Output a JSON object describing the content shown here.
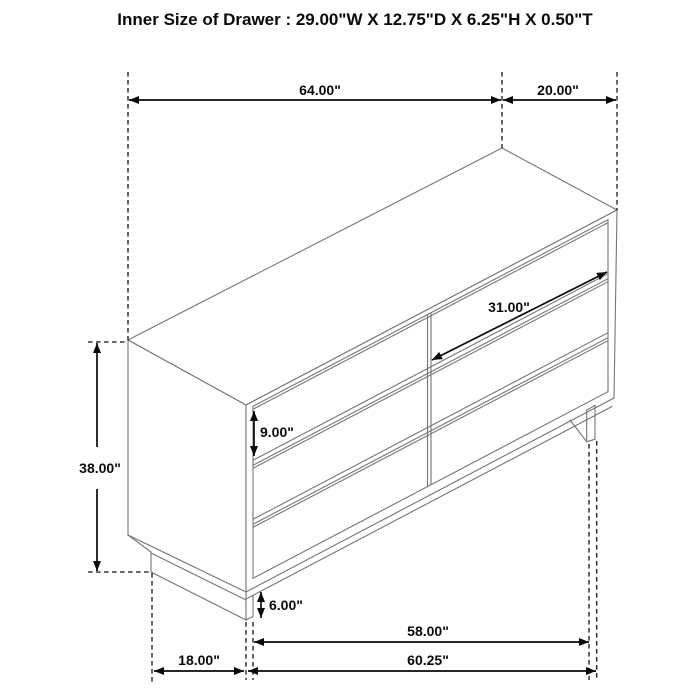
{
  "title": "Inner Size of Drawer : 29.00\"W X 12.75\"D X 6.25\"H X 0.50\"T",
  "figure": {
    "type": "furniture dimension diagram",
    "item": "dresser with 6 drawers (2 columns x 3 rows)",
    "view": "isometric line drawing"
  },
  "dimensions": {
    "top_width": "64.00\"",
    "top_depth": "20.00\"",
    "drawer_width": "31.00\"",
    "drawer_front_height": "9.00\"",
    "overall_height": "38.00\"",
    "base_height": "6.00\"",
    "bottom_inner_width": "58.00\"",
    "bottom_overall_width": "60.25\"",
    "bottom_side_depth": "18.00\""
  },
  "colors": {
    "background": "#ffffff",
    "furniture_line": "#757575",
    "dimension_line": "#0a0a0a",
    "text": "#0a0a0a"
  }
}
